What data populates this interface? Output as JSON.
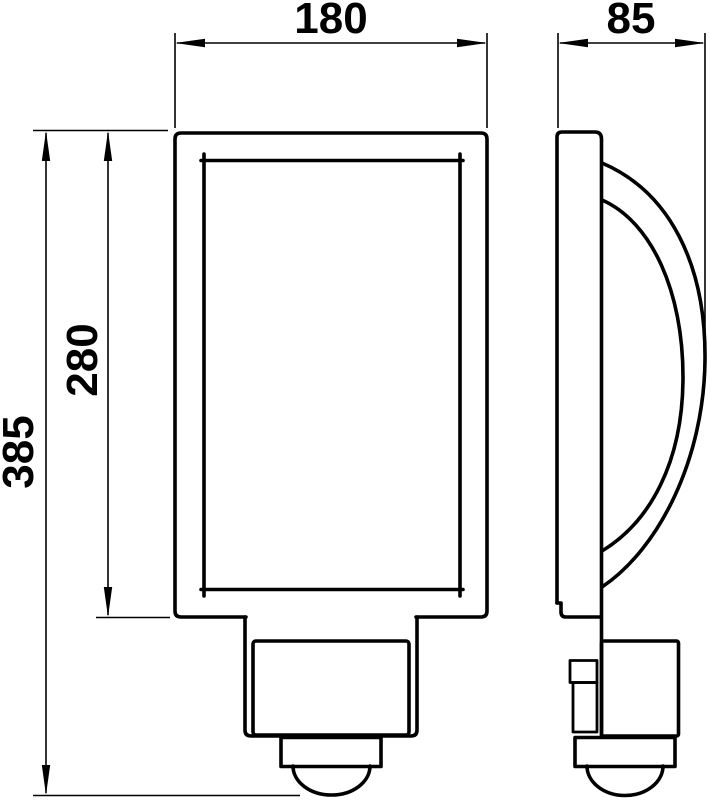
{
  "drawing": {
    "dimension_labels": {
      "width": "180",
      "depth": "85",
      "height_total": "385",
      "height_body": "280"
    },
    "colors": {
      "line": "#000000",
      "background": "#ffffff"
    }
  }
}
